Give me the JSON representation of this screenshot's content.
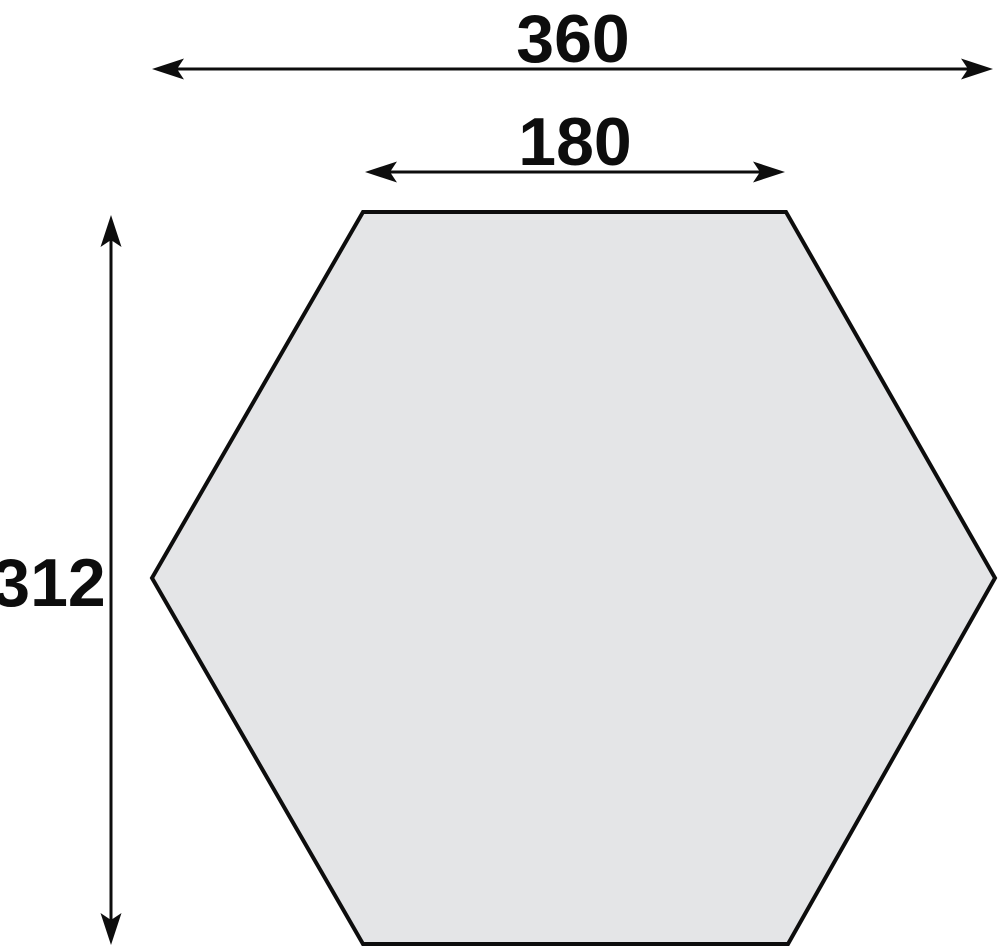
{
  "diagram": {
    "type": "dimensioned-technical-drawing",
    "shape": "hexagon",
    "dimensions": {
      "width_label": "360",
      "top_edge_label": "180",
      "height_label": "312"
    },
    "colors": {
      "shape_fill": "#e4e5e7",
      "shape_stroke": "#0d0d0d",
      "dimension_color": "#0d0d0d",
      "background": "#ffffff"
    }
  }
}
